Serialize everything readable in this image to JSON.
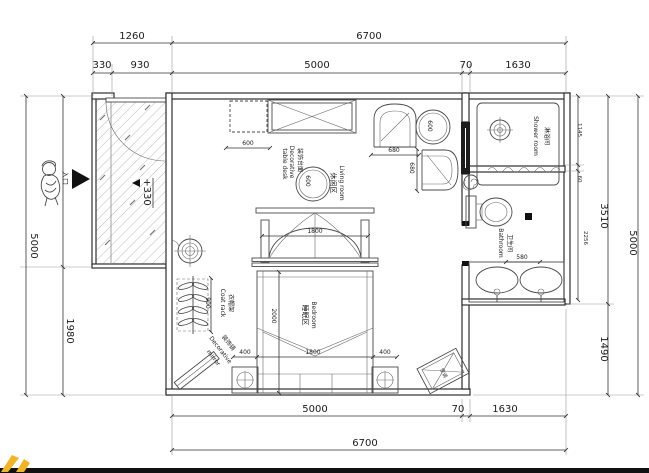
{
  "floorplan": {
    "dims_top": {
      "overall_left": "1260",
      "overall_right": "6700",
      "d330": "330",
      "d930": "930",
      "d5000": "5000",
      "d70": "70",
      "d1630": "1630"
    },
    "dims_bottom": {
      "d5000": "5000",
      "d70": "70",
      "d1630": "1630",
      "overall": "6700"
    },
    "dims_left": {
      "overall": "5000",
      "d1980": "1980"
    },
    "dims_right": {
      "d1145": "1145",
      "d60": "60",
      "d2256": "2256",
      "d3510": "3510",
      "d1490": "1490",
      "overall": "5000"
    },
    "dims_inner": {
      "cabinet": "600",
      "round_table": "600",
      "side_table": "600",
      "chair_w": "680",
      "chair_d": "680",
      "canopy": "1800",
      "bed_length": "2000",
      "bed_width": "1800",
      "left_gap": "400",
      "right_gap": "400",
      "coat_rack": "900",
      "toilet_zone": "580"
    },
    "rooms": {
      "living": {
        "cn": "休闲区",
        "en": "Living room"
      },
      "bedroom": {
        "cn": "睡眠区",
        "en": "Bedroom"
      },
      "shower": {
        "cn": "淋浴间",
        "en": "Shower room"
      },
      "bathroom": {
        "cn": "卫生间",
        "en": "Bathroom"
      }
    },
    "furniture": {
      "coat_rack": {
        "cn": "衣帽架",
        "en": "Coat rack"
      },
      "mirror": {
        "cn": "装饰镜",
        "en1": "Decorative",
        "en2": "mirror"
      },
      "console": {
        "cn": "装饰台面",
        "en1": "Decorative",
        "en2": "table desk"
      },
      "ac": {
        "cn": "空调"
      }
    },
    "annotations": {
      "level": "+330",
      "entrance": "入口"
    },
    "symbols": [
      "entrance-arrow-icon",
      "person-icon",
      "ceiling-light-icon",
      "floor-drain-icon",
      "paper-roll-icon",
      "watermark-fragment"
    ],
    "colors": {
      "line": "#2e2e2e",
      "watermark_yellow": "#f0b429",
      "bottom_bar": "#111111"
    }
  }
}
